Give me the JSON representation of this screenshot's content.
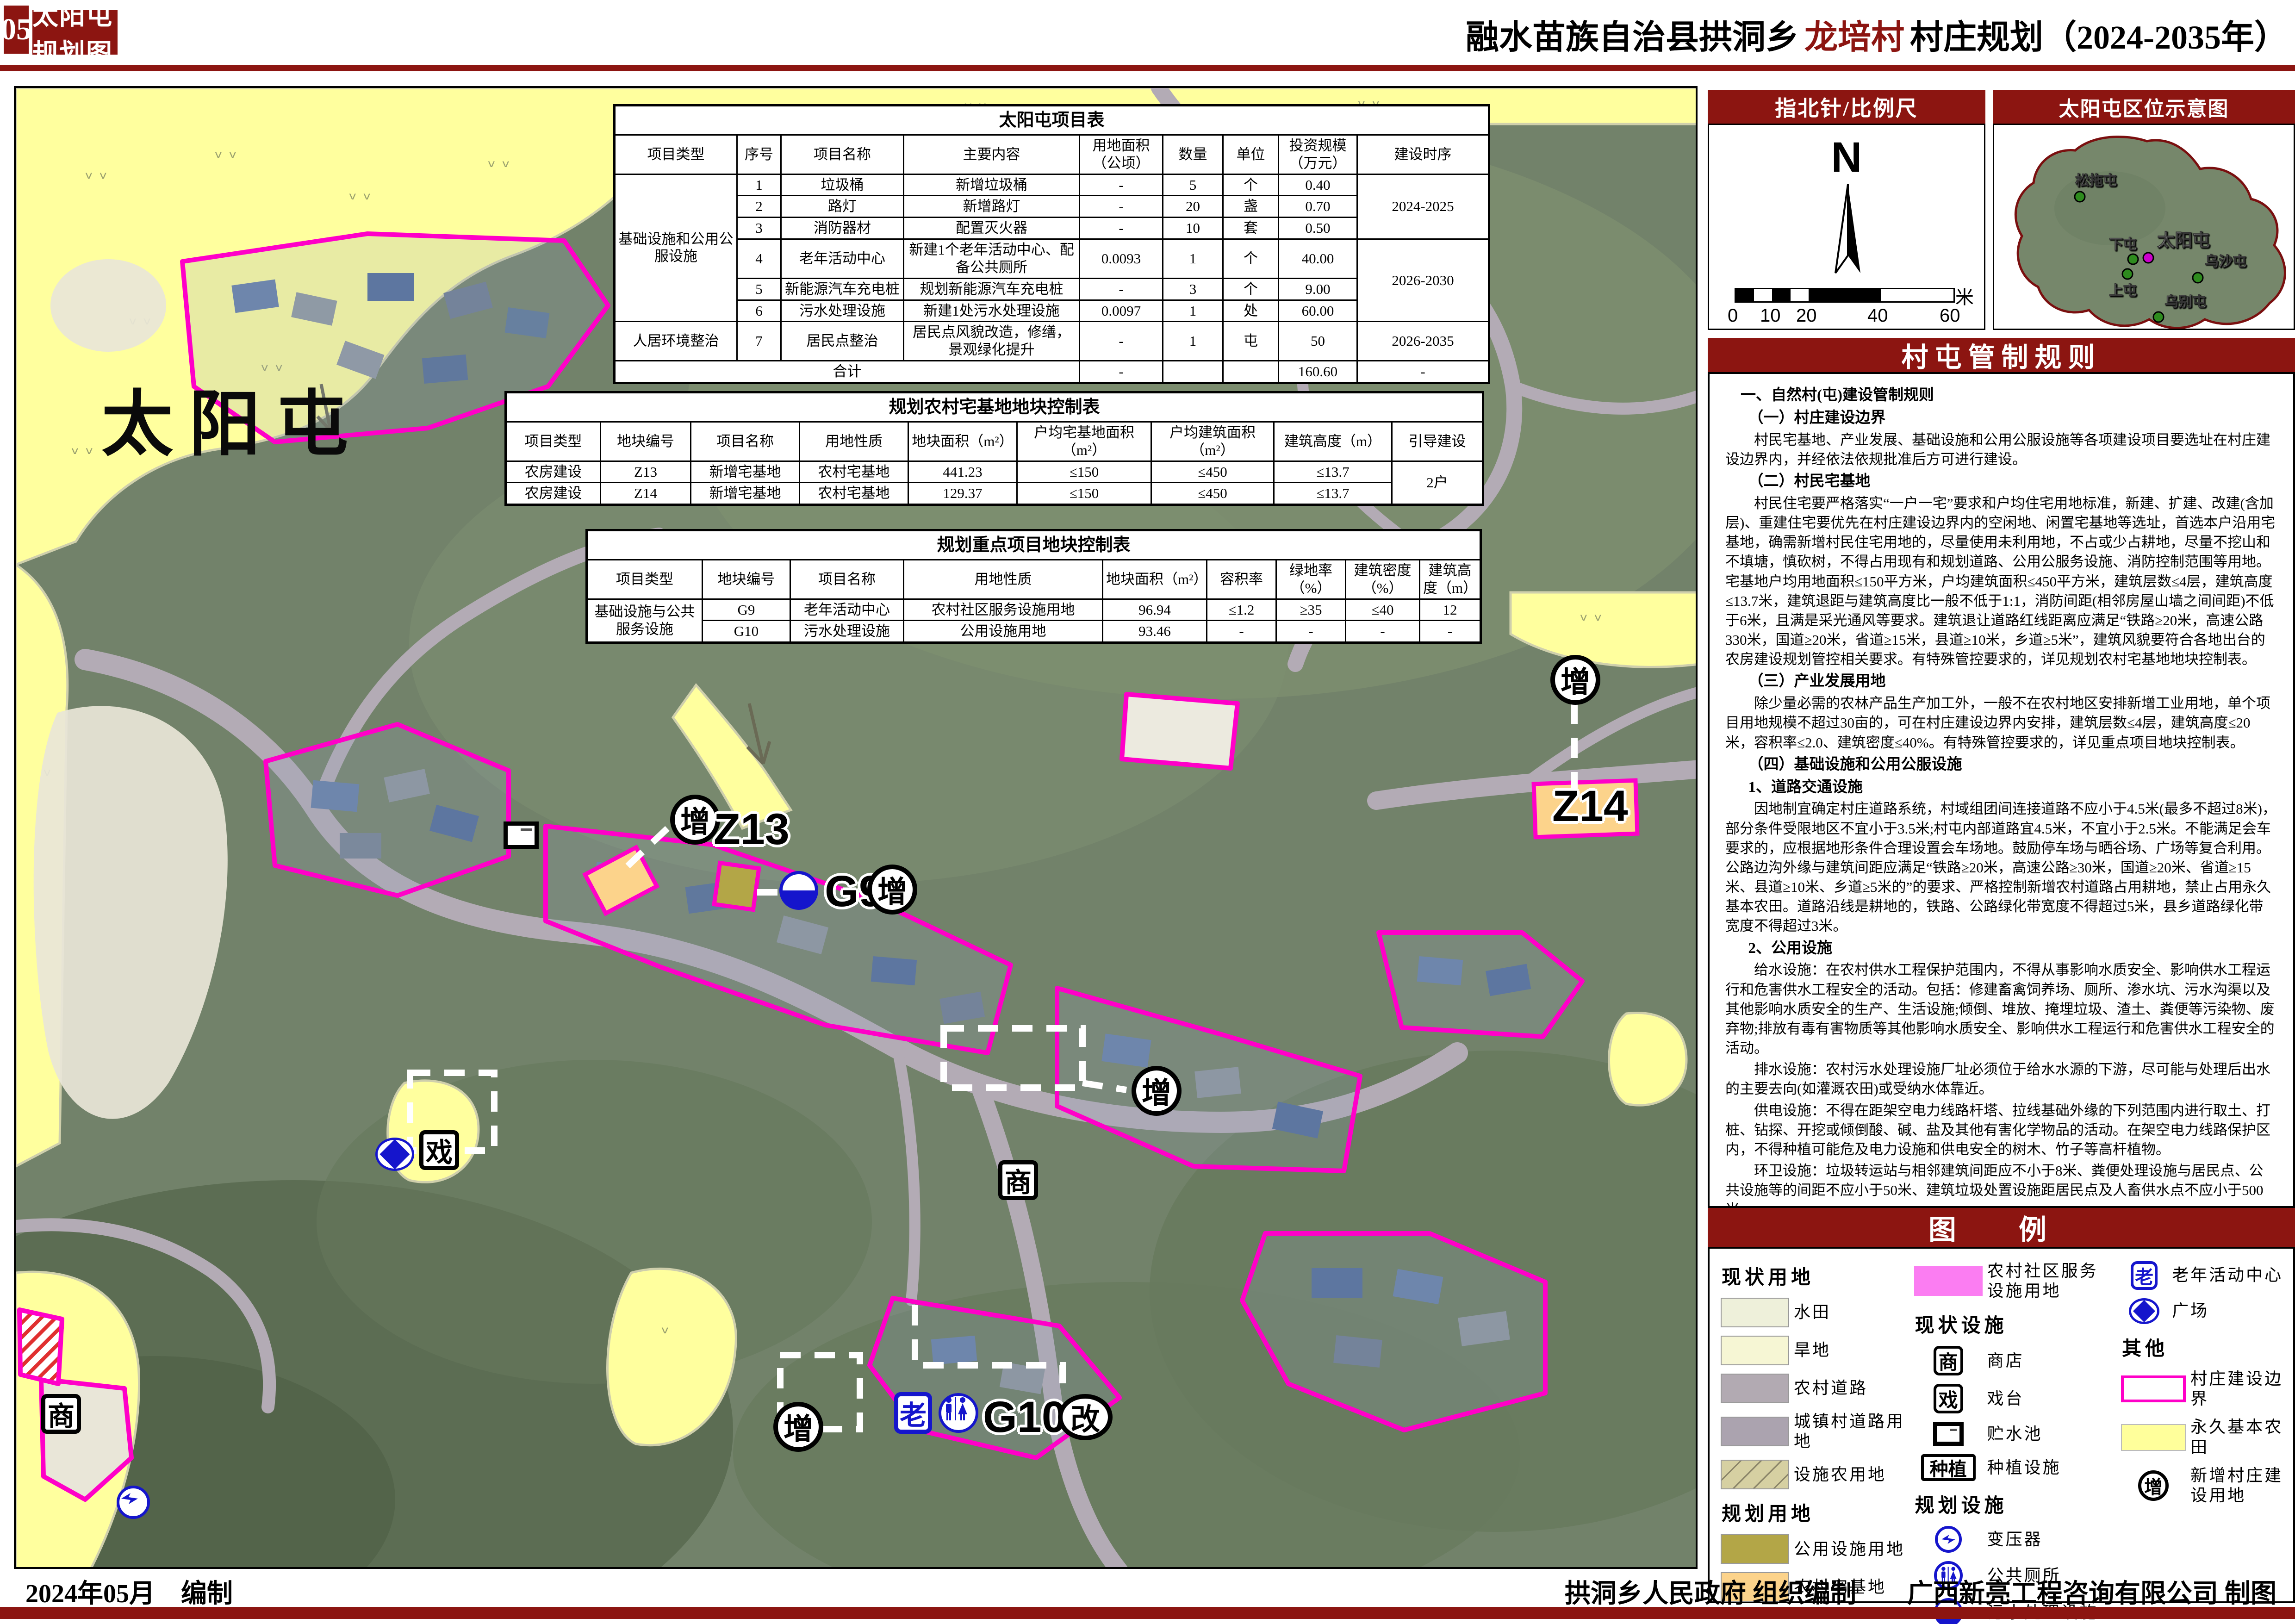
{
  "header": {
    "page_no": "05",
    "title": "太阳屯规划图",
    "subtitle_prefix": "融水苗族自治县拱洞乡",
    "subtitle_highlight": "龙培村",
    "subtitle_suffix": "村庄规划（2024-2035年）"
  },
  "colors": {
    "accent_red": "#8c1511",
    "map_magenta": "#ff00c8",
    "farmland_yellow": "#ffff9e",
    "facility_olive": "#b3a647",
    "homestead_orange": "#fcd38b",
    "community_pink": "#fb7df2",
    "icon_blue": "#1515cc"
  },
  "map": {
    "big_label": "太阳屯",
    "labels": {
      "z13": "Z13",
      "z14": "Z14",
      "g9": "G9",
      "g10": "G10",
      "zeng": "增",
      "gai": "改",
      "shang": "商",
      "xi": "戏",
      "lao": "老"
    }
  },
  "tables": {
    "project": {
      "title": "太阳屯项目表",
      "headers": [
        "项目类型",
        "序号",
        "项目名称",
        "主要内容",
        "用地面积（公顷）",
        "数量",
        "单位",
        "投资规模（万元）",
        "建设时序"
      ],
      "cat1": "基础设施和公用公服设施",
      "cat2": "人居环境整治",
      "phase1": "2024-2025",
      "phase2": "2026-2030",
      "phase3": "2026-2035",
      "rows": [
        {
          "no": "1",
          "name": "垃圾桶",
          "content": "新增垃圾桶",
          "area": "-",
          "qty": "5",
          "unit": "个",
          "invest": "0.40"
        },
        {
          "no": "2",
          "name": "路灯",
          "content": "新增路灯",
          "area": "-",
          "qty": "20",
          "unit": "盏",
          "invest": "0.70"
        },
        {
          "no": "3",
          "name": "消防器材",
          "content": "配置灭火器",
          "area": "-",
          "qty": "10",
          "unit": "套",
          "invest": "0.50"
        },
        {
          "no": "4",
          "name": "老年活动中心",
          "content": "新建1个老年活动中心、配备公共厕所",
          "area": "0.0093",
          "qty": "1",
          "unit": "个",
          "invest": "40.00"
        },
        {
          "no": "5",
          "name": "新能源汽车充电桩",
          "content": "规划新能源汽车充电桩",
          "area": "-",
          "qty": "3",
          "unit": "个",
          "invest": "9.00"
        },
        {
          "no": "6",
          "name": "污水处理设施",
          "content": "新建1处污水处理设施",
          "area": "0.0097",
          "qty": "1",
          "unit": "处",
          "invest": "60.00"
        },
        {
          "no": "7",
          "name": "居民点整治",
          "content": "居民点风貌改造，修缮，景观绿化提升",
          "area": "-",
          "qty": "1",
          "unit": "屯",
          "invest": "50"
        }
      ],
      "total_label": "合计",
      "total_area": "-",
      "total_invest": "160.60",
      "total_phase": "-"
    },
    "homestead": {
      "title": "规划农村宅基地地块控制表",
      "headers": [
        "项目类型",
        "地块编号",
        "项目名称",
        "用地性质",
        "地块面积（m²）",
        "户均宅基地面积（m²）",
        "户均建筑面积（m²）",
        "建筑高度（m）",
        "引导建设"
      ],
      "rows": [
        {
          "type": "农房建设",
          "code": "Z13",
          "name": "新增宅基地",
          "nature": "农村宅基地",
          "area": "441.23",
          "per_area": "≤150",
          "per_build": "≤450",
          "height": "≤13.7",
          "guide": "2户"
        },
        {
          "type": "农房建设",
          "code": "Z14",
          "name": "新增宅基地",
          "nature": "农村宅基地",
          "area": "129.37",
          "per_area": "≤150",
          "per_build": "≤450",
          "height": "≤13.7",
          "guide": ""
        }
      ]
    },
    "key": {
      "title": "规划重点项目地块控制表",
      "headers": [
        "项目类型",
        "地块编号",
        "项目名称",
        "用地性质",
        "地块面积（m²）",
        "容积率",
        "绿地率（%）",
        "建筑密度（%）",
        "建筑高度（m）"
      ],
      "type_label": "基础设施与公共服务设施",
      "rows": [
        {
          "code": "G9",
          "name": "老年活动中心",
          "nature": "农村社区服务设施用地",
          "area": "96.94",
          "far": "≤1.2",
          "green": "≥35",
          "density": "≤40",
          "height": "12"
        },
        {
          "code": "G10",
          "name": "污水处理设施",
          "nature": "公用设施用地",
          "area": "93.46",
          "far": "-",
          "green": "-",
          "density": "-",
          "height": "-"
        }
      ]
    }
  },
  "sidebar": {
    "compass_title": "指北针/比例尺",
    "north": "N",
    "scale_ticks": [
      "0",
      "10",
      "20",
      "40",
      "60"
    ],
    "scale_unit": "米",
    "location_title": "太阳屯区位示意图",
    "villages": {
      "songtuo": "松拖屯",
      "xiatun": "下屯",
      "taiyang": "太阳屯",
      "wusha": "乌沙屯",
      "shangtun": "上屯",
      "wubie": "乌别屯"
    },
    "rules_title": "村屯管制规则",
    "rules": [
      {
        "text": "一、自然村(屯)建设管制规则"
      },
      {
        "text": "（一）村庄建设边界"
      },
      {
        "text": "村民宅基地、产业发展、基础设施和公用公服设施等各项建设项目要选址在村庄建设边界内，并经依法依规批准后方可进行建设。"
      },
      {
        "text": "（二）村民宅基地"
      },
      {
        "text": "村民住宅要严格落实“一户一宅”要求和户均住宅用地标准，新建、扩建、改建(含加层)、重建住宅要优先在村庄建设边界内的空闲地、闲置宅基地等选址，首选本户沿用宅基地，确需新增村民住宅用地的，尽量使用未利用地，不占或少占耕地，尽量不挖山和不填塘，慎砍树，不得占用现有和规划道路、公用公服务设施、消防控制范围等用地。宅基地户均用地面积≤150平方米，户均建筑面积≤450平方米，建筑层数≤4层，建筑高度≤13.7米，建筑退距与建筑高度比一般不低于1:1，消防间距(相邻房屋山墙之间间距)不低于6米，且满是采光通风等要求。建筑退让道路红线距离应满足“铁路≥20米，高速公路330米，国道≥20米，省道≥15米，县道≥10米，乡道≥5米”，建筑风貌要符合各地出台的农房建设规划管控相关要求。有特殊管控要求的，详见规划农村宅基地地块控制表。"
      },
      {
        "text": "（三）产业发展用地"
      },
      {
        "text": "除少量必需的农林产品生产加工外，一般不在农村地区安排新增工业用地，单个项目用地规模不超过30亩的，可在村庄建设边界内安排，建筑层数≤4层，建筑高度≤20米，容积率≤2.0、建筑密度≤40%。有特殊管控要求的，详见重点项目地块控制表。"
      },
      {
        "text": "（四）基础设施和公用公服设施"
      },
      {
        "text": "1、道路交通设施"
      },
      {
        "text": "因地制宜确定村庄道路系统，村域组团间连接道路不应小于4.5米(最多不超过8米)，部分条件受限地区不宜小于3.5米;村屯内部道路宜4.5米，不宜小于2.5米。不能满足会车要求的，应根据地形条件合理设置会车场地。鼓励停车场与晒谷场、广场等复合利用。公路边沟外缘与建筑间距应满足“铁路≥20米，高速公路≥30米，国道≥20米、省道≥15米、县道≥10米、乡道≥5米的”的要求、严格控制新增农村道路占用耕地，禁止占用永久基本农田。道路沿线是耕地的，铁路、公路绿化带宽度不得超过5米，县乡道路绿化带宽度不得超过3米。"
      },
      {
        "text": "2、公用设施"
      },
      {
        "text": "给水设施：在农村供水工程保护范围内，不得从事影响水质安全、影响供水工程运行和危害供水工程安全的活动。包括：修建畜禽饲养场、厕所、渗水坑、污水沟渠以及其他影响水质安全的生产、生活设施;倾倒、堆放、掩埋垃圾、渣土、粪便等污染物、废弃物;排放有毒有害物质等其他影响水质安全、影响供水工程运行和危害供水工程安全的活动。"
      },
      {
        "text": "排水设施：农村污水处理设施厂址必须位于给水水源的下游，尽可能与处理后出水的主要去向(如灌溉农田)或受纳水体靠近。"
      },
      {
        "text": "供电设施：不得在距架空电力线路杆塔、拉线基础外缘的下列范围内进行取土、打桩、钻探、开挖或倾倒酸、碱、盐及其他有害化学物品的活动。在架空电力线路保护区内，不得种植可能危及电力设施和供电安全的树木、竹子等高杆植物。"
      },
      {
        "text": "环卫设施：垃圾转运站与相邻建筑间距应不小于8米、粪便处理设施与居民点、公共设施等的间距不应小于50米、建筑垃圾处置设施距居民点及人畜供水点不应小于500米。"
      },
      {
        "text": "消防设施：消防设备布置应充分考虑消防水源和电源管线、通道与建筑主体之间的距离、灭火设备的易用性，严禁在消防通道、消防电源管线以及消防水源上堆放杂物、摆放物品或停放车辆。"
      },
      {
        "text": "3、公共服务设施"
      },
      {
        "text": "鼓励农村“三室一点”(即村委办公室、老年活动室、卫生室和健身点)和公共服务设施综合设置，复合利用。公共建筑新增配置以村民使用需求为基础，建筑体量适中，不得浪费土地，且建筑(除鼓楼外)层数宜≤3层，建筑总高度≤12米，有特殊管控要求的，详见重点项目地块控制表。"
      },
      {
        "text": "（五）存量建设用地引导"
      },
      {
        "text": "现状村庄建设用地（203图斑）已明确“留”、“改”、“拆”、“减”四种类型的，要审慎处置既有建筑等存量空间。“留”：以保留利用提升为主，鼓励小规模、渐进式有机更新和微改造，提高安全性、适用性。“改”：鼓励已依法登记的宅基地等农村建设用地复合利用，按规划要求改变地块用途用于工业、商业、旅游等经营性用途，发展乡村民宿、农产品初加工、电子商务等农村产业。“拆”：除违法建筑和经专业机构鉴定为危房，且无修缮保留价值的建筑外，不应大规模、成片集中拆除现状建筑。“减”：对于实地没有建筑物的现状村庄建设用地（203图斑），且近10年没有开发建设计划的，可作为腾退空间，调出现状村庄建设用地（203图斑）范围，腾退的建设用地指标优先保障本村村民住宅建设合理用地需求。"
      }
    ]
  },
  "legend": {
    "title": "图 例",
    "current_land": "现状用地",
    "planned_land": "规划用地",
    "current_fac": "现状设施",
    "planned_fac": "规划设施",
    "other": "其他",
    "items": {
      "paddy": "水田",
      "dry": "旱地",
      "rural_road": "农村道路",
      "town_road": "城镇村道路用地",
      "fac_farm": "设施农用地",
      "public_fac_land": "公用设施用地",
      "homestead": "农村宅基地",
      "community": "农村社区服务设施用地",
      "shop": "商店",
      "stage": "戏台",
      "reservoir": "贮水池",
      "plant": "种植设施",
      "transformer": "变压器",
      "toilet": "公共厕所",
      "sewage": "污水处理设施",
      "elder": "老年活动中心",
      "square": "广场",
      "boundary": "村庄建设边界",
      "farmland": "永久基本农田",
      "new_land": "新增村庄建设用地"
    },
    "icon_chars": {
      "shop": "商",
      "stage": "戏",
      "plant": "种植",
      "elder": "老",
      "zeng": "增"
    }
  },
  "footer": {
    "left": "2024年05月　编制",
    "right1": "拱洞乡人民政府 组织编制",
    "right2": "广西新亮工程咨询有限公司 制图"
  }
}
